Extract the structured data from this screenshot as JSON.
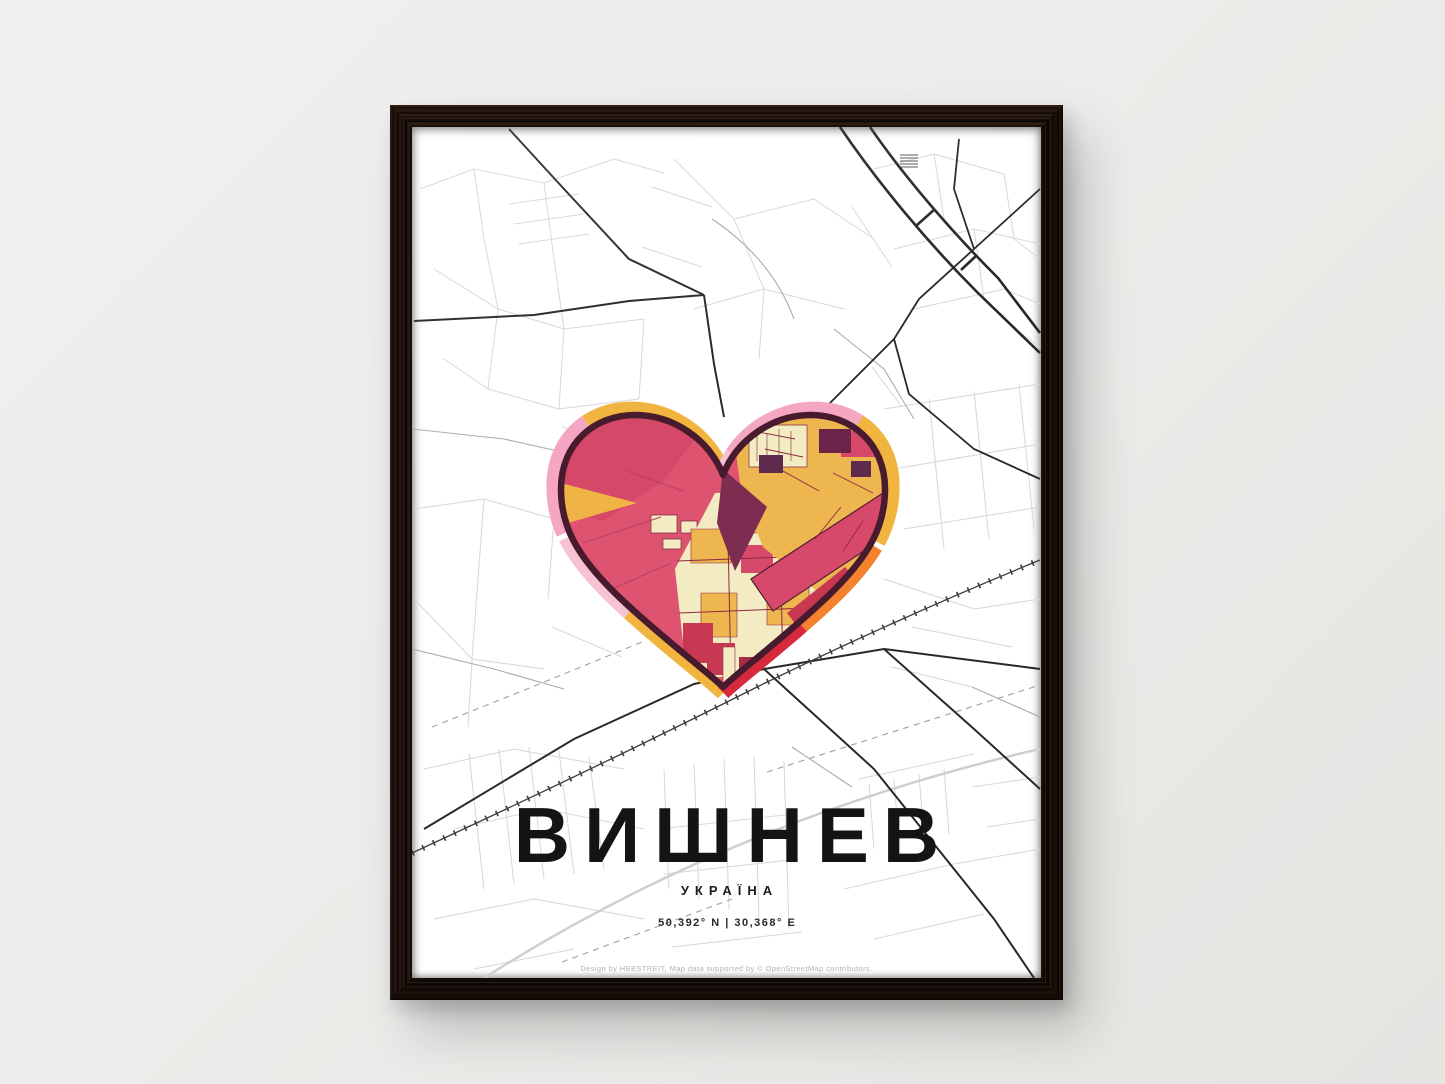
{
  "poster": {
    "title": "ВИШНЕВ",
    "subtitle": "УКРАЇНА",
    "coordinates": "50,392° N | 30,368° E",
    "credit": "Design by HEBSTREIT, Map data supported by © OpenStreetMap contributors."
  },
  "palette": {
    "wall": "#edecea",
    "frame_wood": "#20150e",
    "map_street_light": "#d7d7d7",
    "map_street_medium": "#ababab",
    "map_road_dark": "#282828",
    "heart_base_crimson": "#dd5370",
    "heart_amber": "#eeb64e",
    "heart_cream": "#f3ecc3",
    "heart_red_block": "#c93853",
    "heart_purple": "#5e2b4e",
    "heart_outline_maroon": "#471b2d",
    "glow_pink": "#f5a6c2",
    "glow_pale_pink": "#f7c3d2",
    "glow_amber": "#f0b43f",
    "glow_orange": "#f4812d",
    "glow_red": "#d62a3c"
  }
}
